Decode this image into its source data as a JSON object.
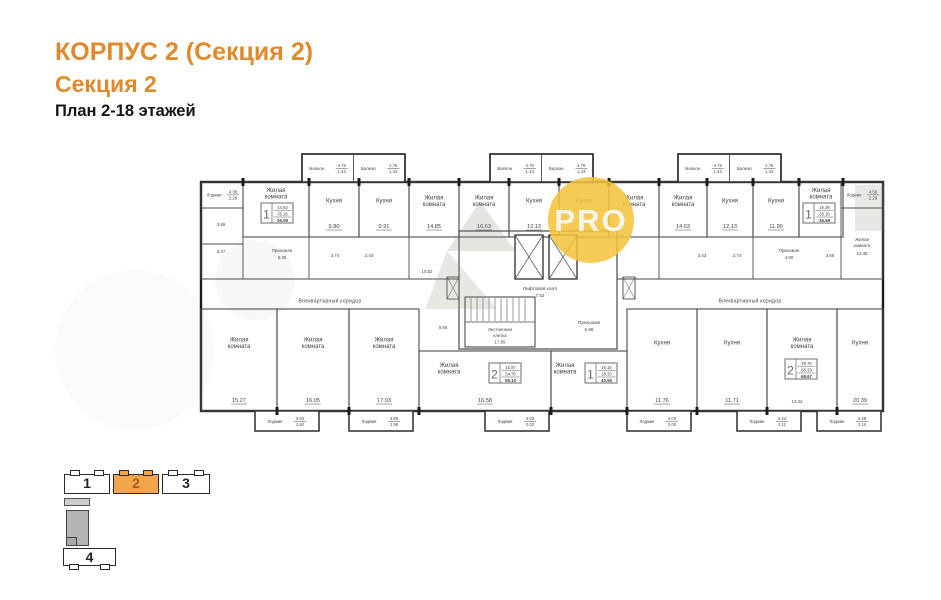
{
  "title": {
    "line1": "КОРПУС 2 (Секция 2)",
    "line2": "Секция 2",
    "line3": "План 2-18 этажей"
  },
  "colors": {
    "accent": "#e1892d",
    "minimap_active": "#f3a44f",
    "minimap_active_num": "#a6601c",
    "wall_dark": "#1c1c1c",
    "wall": "#4a4a4a",
    "text": "#3f3f3f",
    "badge": "#f4c33c",
    "badge_text": "#faf8f2",
    "watermark": "#8f8577"
  },
  "badge": {
    "text": "PRO"
  },
  "minimap": {
    "blocks": [
      {
        "label": "1",
        "active": false
      },
      {
        "label": "2",
        "active": true
      },
      {
        "label": "3",
        "active": false
      },
      {
        "label": "4",
        "active": false
      }
    ]
  },
  "plan": {
    "balcony_label": "Балкон",
    "balcony_frac": [
      "4.76",
      "1.43"
    ],
    "balcony_blocks": [
      {
        "x": 105
      },
      {
        "x": 293
      },
      {
        "x": 481
      }
    ],
    "corner_loggias": [
      {
        "x": 4,
        "label": "Лоджия",
        "frac": [
          "4.38",
          "2.29"
        ]
      },
      {
        "x": 644,
        "label": "Лоджия",
        "frac": [
          "4.58",
          "2.29"
        ]
      }
    ],
    "bottom_loggias": [
      {
        "x": 58,
        "label": "Лоджия",
        "frac": [
          "3.84",
          "1.92"
        ]
      },
      {
        "x": 152,
        "label": "Лоджия",
        "frac": [
          "3.89",
          "1.96"
        ]
      },
      {
        "x": 288,
        "label": "Лоджия",
        "frac": [
          "4.03",
          "2.02"
        ]
      },
      {
        "x": 430,
        "label": "Лоджия",
        "frac": [
          "4.03",
          "2.00"
        ]
      },
      {
        "x": 540,
        "label": "Лоджия",
        "frac": [
          "4.23",
          "2.11"
        ]
      },
      {
        "x": 620,
        "label": "Лоджия",
        "frac": [
          "4.28",
          "2.14"
        ]
      }
    ],
    "rooms": [
      {
        "label": "Жилая комната",
        "x": 46,
        "y": 31,
        "w": 66,
        "h": 55,
        "ly": 41,
        "box": {
          "num": "1",
          "rows": [
            "14.83",
            "35.16",
            "36.59"
          ],
          "bx": 64,
          "by": 52
        }
      },
      {
        "label": "Кухня",
        "area": "9.80",
        "x": 112,
        "y": 31,
        "w": 50,
        "h": 55
      },
      {
        "label": "Кухня",
        "area": "9.91",
        "x": 162,
        "y": 31,
        "w": 50,
        "h": 55
      },
      {
        "label": "Жилая комната",
        "area": "14.85",
        "x": 212,
        "y": 31,
        "w": 50,
        "h": 55
      },
      {
        "label": "Жилая комната",
        "area": "16.63",
        "x": 262,
        "y": 31,
        "w": 50,
        "h": 55
      },
      {
        "label": "Кухня",
        "area": "12.13",
        "x": 312,
        "y": 31,
        "w": 50,
        "h": 55
      },
      {
        "label": "Кухня",
        "x": 362,
        "y": 31,
        "w": 50,
        "h": 55
      },
      {
        "label": "Жилая комната",
        "x": 412,
        "y": 31,
        "w": 50,
        "h": 55
      },
      {
        "label": "Жилая комната",
        "area": "14.63",
        "x": 462,
        "y": 31,
        "w": 48,
        "h": 55
      },
      {
        "label": "Кухня",
        "area": "12.13",
        "x": 510,
        "y": 31,
        "w": 46,
        "h": 55
      },
      {
        "label": "Кухня",
        "area": "11.90",
        "x": 556,
        "y": 31,
        "w": 46,
        "h": 55
      },
      {
        "label": "Жилая комната",
        "x": 602,
        "y": 31,
        "w": 44,
        "h": 55,
        "ly": 41,
        "box": {
          "num": "1",
          "rows": [
            "16.36",
            "35.16",
            "36.59"
          ],
          "bx": 606,
          "by": 52
        }
      },
      {
        "label": "Жилая комната",
        "area": "15.27",
        "x": 4,
        "y": 158,
        "w": 76,
        "h": 102
      },
      {
        "label": "Жилая комната",
        "area": "16.05",
        "x": 80,
        "y": 158,
        "w": 72,
        "h": 102
      },
      {
        "label": "Жилая комната",
        "area": "17.93",
        "x": 152,
        "y": 158,
        "w": 70,
        "h": 102
      },
      {
        "label": "Жилая комната",
        "area": "16.58",
        "x": 222,
        "y": 200,
        "w": 132,
        "h": 60,
        "lx": 252,
        "ly": 216,
        "box": {
          "num": "2",
          "rows": [
            "16.87",
            "54.76",
            "56.10"
          ],
          "bx": 292,
          "by": 212
        }
      },
      {
        "label": "Жилая комната",
        "x": 354,
        "y": 200,
        "w": 76,
        "h": 60,
        "lx": 368,
        "ly": 216,
        "box": {
          "num": "1",
          "rows": [
            "16.16",
            "38.33",
            "40.55"
          ],
          "bx": 388,
          "by": 212
        }
      },
      {
        "label": "Кухня",
        "area": "11.76",
        "x": 430,
        "y": 158,
        "w": 70,
        "h": 102
      },
      {
        "label": "Кухня",
        "area": "11.71",
        "x": 500,
        "y": 158,
        "w": 70,
        "h": 102
      },
      {
        "label": "Жилая комната",
        "x": 570,
        "y": 158,
        "w": 70,
        "h": 102,
        "box": {
          "num": "2",
          "rows": [
            "29.76",
            "66.33",
            "68.67"
          ],
          "bx": 588,
          "by": 208
        }
      },
      {
        "label": "Кухня",
        "area": "20.39",
        "x": 640,
        "y": 158,
        "w": 46,
        "h": 102
      }
    ],
    "core": {
      "hall": "Лифтовой холл",
      "hall_area": "7.52",
      "stairs_l1": "Лестничная",
      "stairs_l2": "клетка",
      "stairs_area": "17.65",
      "entry": "Прихожая",
      "entry_area": "5.99"
    },
    "corridor_left": "Внеквартирный коридор",
    "corridor_right": "Внеквартирный коридор",
    "small_texts": [
      {
        "x": 85,
        "y": 101,
        "t": "Прихожая"
      },
      {
        "x": 85,
        "y": 108,
        "t": "6.30"
      },
      {
        "x": 138,
        "y": 106,
        "t": "3.74"
      },
      {
        "x": 172,
        "y": 106,
        "t": "3.43"
      },
      {
        "x": 24,
        "y": 75,
        "t": "3.89"
      },
      {
        "x": 24,
        "y": 102,
        "t": "3.47"
      },
      {
        "x": 230,
        "y": 122,
        "t": "10.52"
      },
      {
        "x": 246,
        "y": 178,
        "t": "9.68"
      },
      {
        "x": 505,
        "y": 106,
        "t": "3.43"
      },
      {
        "x": 540,
        "y": 106,
        "t": "3.74"
      },
      {
        "x": 592,
        "y": 101,
        "t": "Прихожая"
      },
      {
        "x": 592,
        "y": 108,
        "t": "4.00"
      },
      {
        "x": 633,
        "y": 106,
        "t": "3.65"
      },
      {
        "x": 665,
        "y": 90,
        "t": "Жилая"
      },
      {
        "x": 665,
        "y": 96,
        "t": "комната"
      },
      {
        "x": 665,
        "y": 104,
        "t": "12.48"
      },
      {
        "x": 600,
        "y": 252,
        "t": "13.22"
      }
    ],
    "extra_rects": [
      {
        "x": 4,
        "y": 57,
        "w": 42,
        "h": 36
      },
      {
        "x": 4,
        "y": 93,
        "w": 42,
        "h": 35
      },
      {
        "x": 644,
        "y": 57,
        "w": 42,
        "h": 71
      }
    ],
    "extra_lines": [
      {
        "x1": 112,
        "y1": 86,
        "x2": 112,
        "y2": 128
      },
      {
        "x1": 212,
        "y1": 86,
        "x2": 212,
        "y2": 128
      },
      {
        "x1": 462,
        "y1": 86,
        "x2": 462,
        "y2": 128
      },
      {
        "x1": 556,
        "y1": 86,
        "x2": 556,
        "y2": 128
      },
      {
        "x1": 4,
        "y1": 128,
        "x2": 262,
        "y2": 128
      },
      {
        "x1": 420,
        "y1": 128,
        "x2": 686,
        "y2": 128
      }
    ],
    "vents": [
      {
        "x": 250,
        "y": 126,
        "w": 12,
        "h": 22
      },
      {
        "x": 426,
        "y": 126,
        "w": 12,
        "h": 22
      }
    ],
    "ticks_top": [
      46,
      112,
      162,
      212,
      262,
      312,
      362,
      412,
      462,
      510,
      556,
      602,
      646
    ],
    "ticks_bottom": [
      80,
      152,
      222,
      354,
      430,
      500,
      570,
      640
    ]
  }
}
